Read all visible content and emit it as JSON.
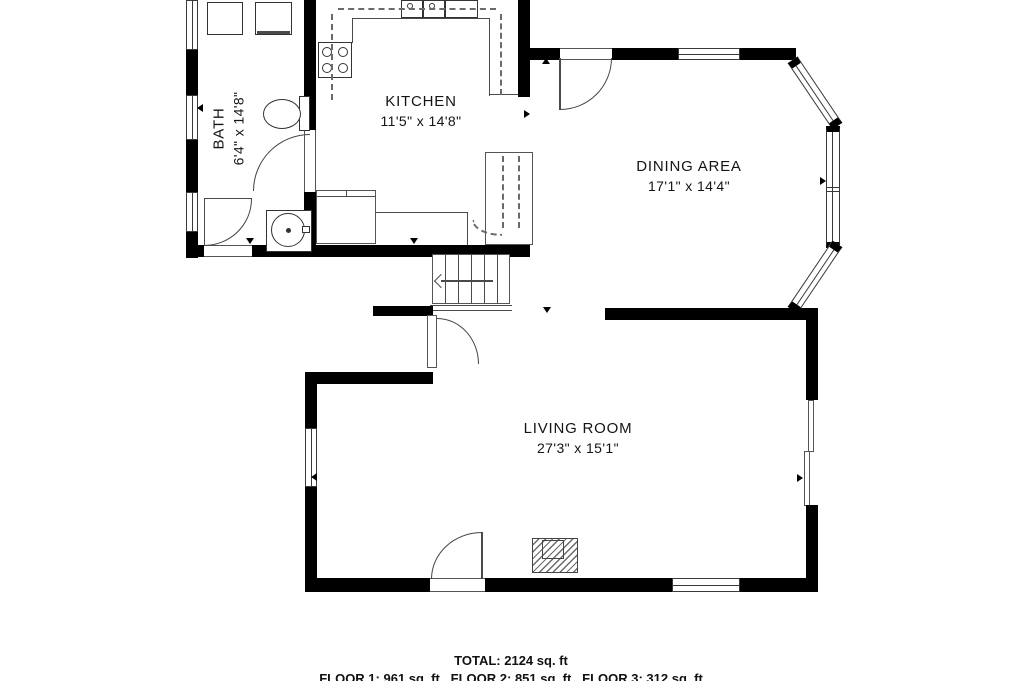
{
  "plan": {
    "rooms": [
      {
        "name": "KITCHEN",
        "dims": "11'5\" x 14'8\""
      },
      {
        "name": "BATH",
        "dims": "6'4\" x 14'8\""
      },
      {
        "name": "DINING AREA",
        "dims": "17'1\" x 14'4\""
      },
      {
        "name": "LIVING ROOM",
        "dims": "27'3\" x 15'1\""
      }
    ],
    "summary": {
      "total": "TOTAL: 2124 sq. ft",
      "floors": "FLOOR 1: 961 sq. ft   FLOOR 2: 851 sq. ft   FLOOR 3: 312 sq. ft"
    }
  }
}
